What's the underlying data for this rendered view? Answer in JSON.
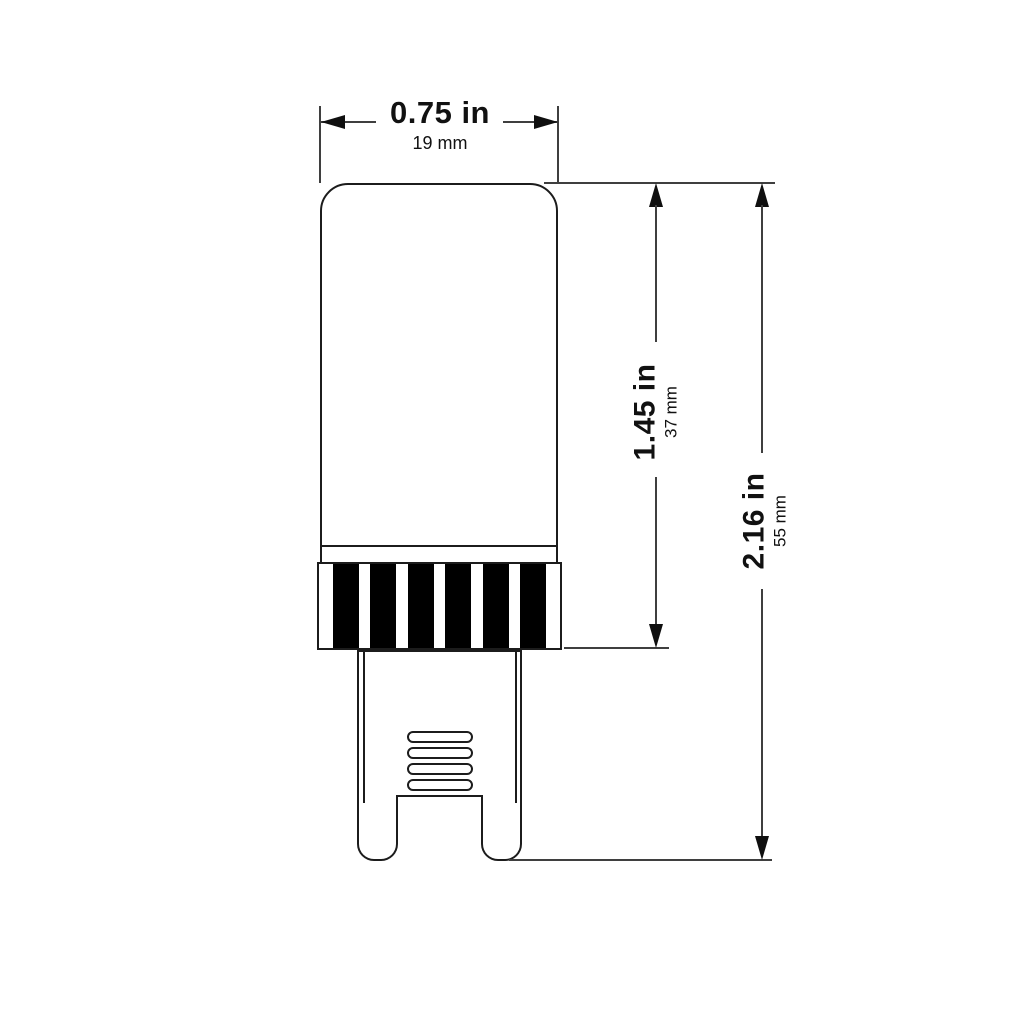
{
  "dims": {
    "width": {
      "inches": "0.75 in",
      "millimeters": "19 mm"
    },
    "body_height": {
      "inches": "1.45 in",
      "millimeters": "37 mm"
    },
    "overall_height": {
      "inches": "2.16 in",
      "millimeters": "55 mm"
    }
  },
  "collar_stripe_count": 6,
  "vent_slot_count": 4,
  "colors": {
    "background": "#ffffff",
    "outline": "#1c1c1c",
    "dimension_line": "#3f3f3f",
    "arrow": "#0f0f0f",
    "stripe": "#000000",
    "text": "#111111"
  }
}
